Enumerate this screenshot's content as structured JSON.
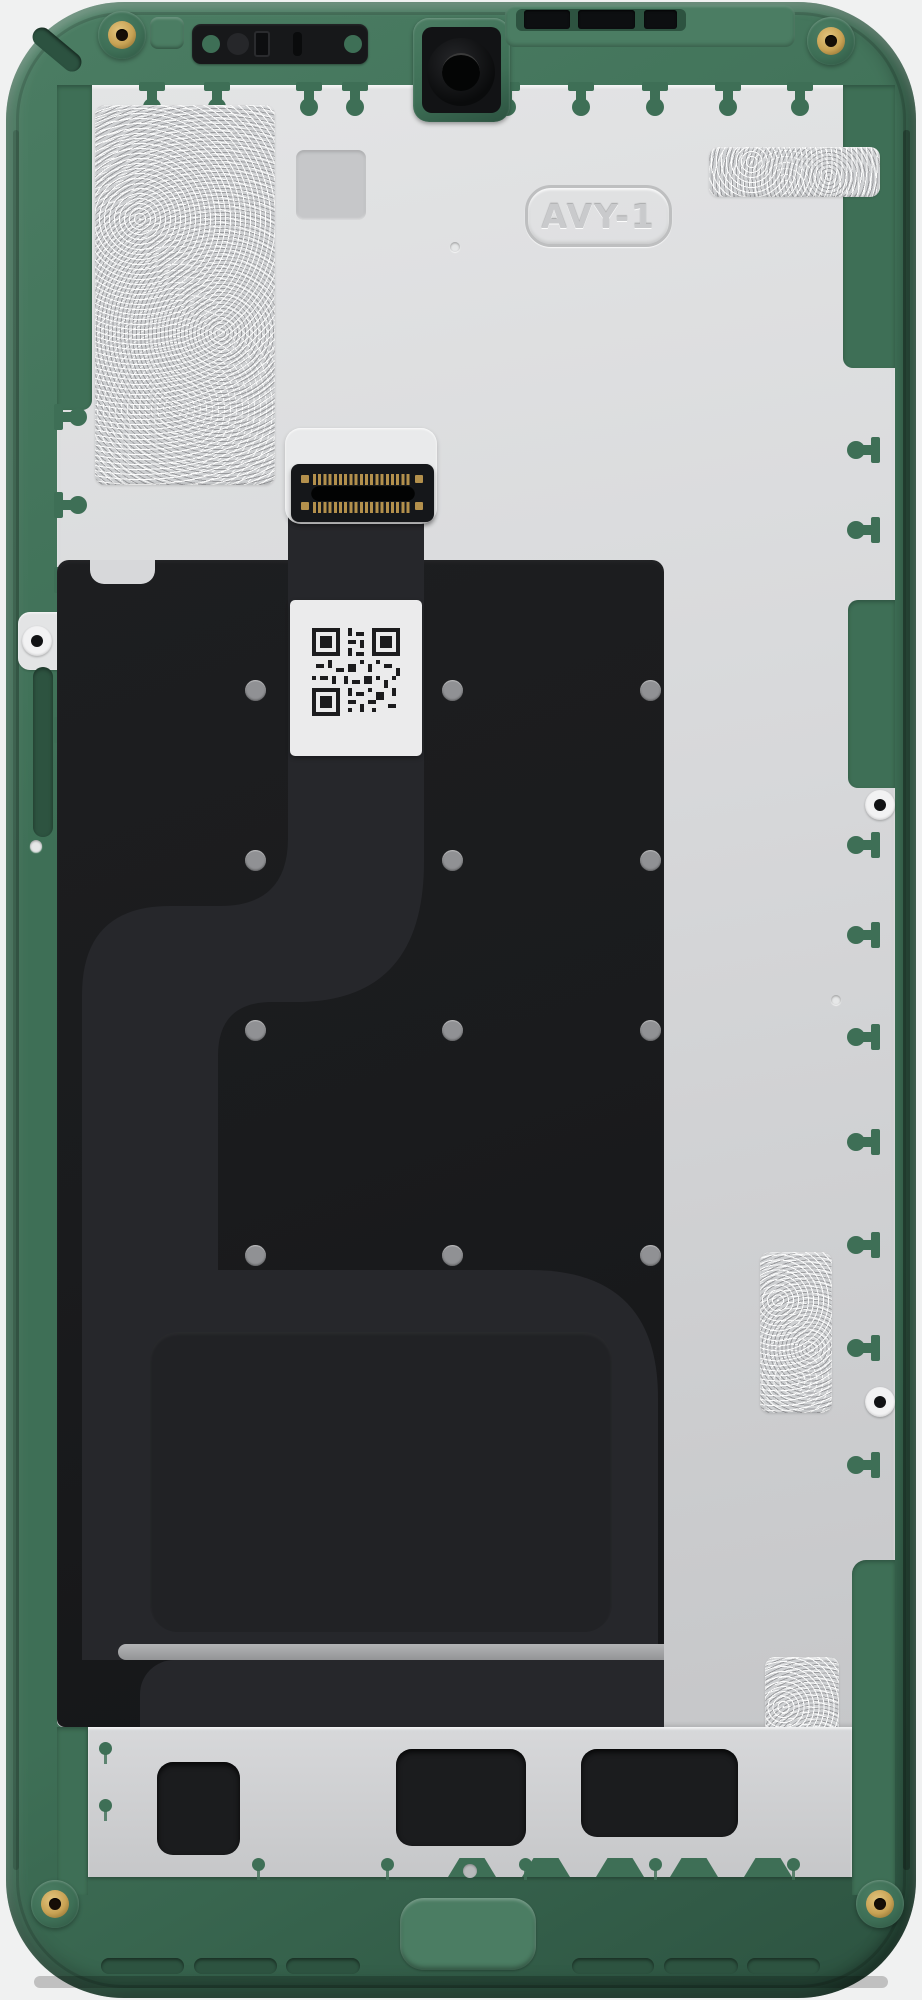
{
  "scene": {
    "type": "product-photo",
    "subject": "smartphone display assembly, rear view, green mid-frame with silver EMI shield, graphite sheet, display flex cable and QR label",
    "orientation": "portrait"
  },
  "labels": {
    "shield_emboss": "AVY-1"
  },
  "palette": {
    "bg": "#f0f1f1",
    "frame": "#3e6f56",
    "frameDark": "#2c5240",
    "frameLight": "#4b7d63",
    "pin": "#3e6f56",
    "shield": "#d7d8da",
    "shieldLight": "#e3e4e5",
    "shieldDark": "#c6c7c9",
    "foil": "#ced0d2",
    "panel": "#1a1b1d",
    "flex": "#26272b",
    "flexDark": "#212225",
    "connector": "#15171a",
    "gold": "#b3904c",
    "brass": "#c8a254",
    "label": "#ebebec",
    "dotGray": "#909194",
    "slotDark": "#2d5340",
    "qrInk": "#1c1c1e"
  },
  "components": {
    "frame": "green polymer mid-frame",
    "shield": "silver graphite-coated EMI shield plate with jigsaw tab edges",
    "earpiece": "earpiece speaker recess",
    "front_camera": "front camera lens in green mount",
    "antenna_slots": "antenna line slots, top edge",
    "corner_screws": "brass threaded screw inserts, four corners",
    "flex_cable": "display flex ribbon with S-curve routing",
    "board_connector": "board-to-board connector with gold contacts",
    "qr_label": "white QR code service label",
    "foil_patches": "textured adhesive foil patches",
    "bottom_bracket": "lower metal bracket with component cutouts",
    "bottom_slots": "speaker / microphone slots in bottom frame"
  },
  "repeats": {
    "pins_top": [
      {
        "left": 147,
        "top": 85
      },
      {
        "left": 212,
        "top": 85
      },
      {
        "left": 304,
        "top": 85
      },
      {
        "left": 350,
        "top": 85
      },
      {
        "left": 428,
        "top": 85
      },
      {
        "left": 502,
        "top": 85
      },
      {
        "left": 576,
        "top": 85
      },
      {
        "left": 650,
        "top": 85
      },
      {
        "left": 723,
        "top": 85
      },
      {
        "left": 795,
        "top": 85
      }
    ],
    "pins_leftedge": [
      {
        "left": 57,
        "top": 412
      },
      {
        "left": 57,
        "top": 500
      },
      {
        "left": 57,
        "top": 575
      },
      {
        "left": 57,
        "top": 725
      },
      {
        "left": 57,
        "top": 930
      },
      {
        "left": 57,
        "top": 1145
      },
      {
        "left": 57,
        "top": 1380
      },
      {
        "left": 57,
        "top": 1630
      }
    ],
    "pins_rightedge": [
      {
        "left": 857,
        "top": 445
      },
      {
        "left": 857,
        "top": 525
      },
      {
        "left": 857,
        "top": 840
      },
      {
        "left": 857,
        "top": 930
      },
      {
        "left": 857,
        "top": 1032
      },
      {
        "left": 857,
        "top": 1137
      },
      {
        "left": 857,
        "top": 1240
      },
      {
        "left": 857,
        "top": 1343
      },
      {
        "left": 857,
        "top": 1460
      }
    ],
    "foil_patches": [
      {
        "left": 95,
        "top": 105,
        "width": 180,
        "height": 380
      },
      {
        "left": 709,
        "top": 147,
        "width": 171,
        "height": 50
      },
      {
        "left": 760,
        "top": 1252,
        "width": 72,
        "height": 161
      },
      {
        "left": 765,
        "top": 1657,
        "width": 74,
        "height": 167
      }
    ],
    "panel_dots": [
      {
        "left": 245,
        "top": 680
      },
      {
        "left": 442,
        "top": 680
      },
      {
        "left": 640,
        "top": 680
      },
      {
        "left": 245,
        "top": 850
      },
      {
        "left": 442,
        "top": 850
      },
      {
        "left": 640,
        "top": 850
      },
      {
        "left": 245,
        "top": 1020
      },
      {
        "left": 442,
        "top": 1020
      },
      {
        "left": 640,
        "top": 1020
      },
      {
        "left": 245,
        "top": 1245
      },
      {
        "left": 442,
        "top": 1245
      },
      {
        "left": 640,
        "top": 1245
      }
    ],
    "shield_dimples": [
      {
        "left": 450,
        "top": 242,
        "width": 10,
        "height": 10
      },
      {
        "left": 831,
        "top": 995,
        "width": 10,
        "height": 10
      },
      {
        "left": 30,
        "top": 840,
        "width": 12,
        "height": 12
      }
    ],
    "shield_holes": [
      {
        "left": 865,
        "top": 790
      },
      {
        "left": 865,
        "top": 1387
      },
      {
        "left": 22,
        "top": 626
      }
    ],
    "connector_pads": [
      {
        "left": 301,
        "top": 475
      },
      {
        "left": 415,
        "top": 475
      },
      {
        "left": 301,
        "top": 502
      },
      {
        "left": 415,
        "top": 502
      }
    ],
    "bracket_cutouts": [
      {
        "left": 157,
        "top": 1762,
        "width": 83,
        "height": 93
      },
      {
        "left": 396,
        "top": 1749,
        "width": 130,
        "height": 97
      },
      {
        "left": 581,
        "top": 1749,
        "width": 157,
        "height": 88
      }
    ],
    "bracket_tabs": [
      {
        "left": 448,
        "top": 1858
      },
      {
        "left": 522,
        "top": 1858
      },
      {
        "left": 596,
        "top": 1858
      },
      {
        "left": 670,
        "top": 1858
      },
      {
        "left": 744,
        "top": 1858
      }
    ],
    "rivets_green": [
      {
        "left": 252,
        "top": 1858
      },
      {
        "left": 381,
        "top": 1858
      },
      {
        "left": 519,
        "top": 1858
      },
      {
        "left": 649,
        "top": 1858
      },
      {
        "left": 787,
        "top": 1858
      },
      {
        "left": 99,
        "top": 1742
      },
      {
        "left": 99,
        "top": 1799
      }
    ],
    "rivets_gray": [
      {
        "left": 463,
        "top": 1864
      }
    ],
    "bottom_slots": [
      {
        "left": 101,
        "top": 1958,
        "width": 83
      },
      {
        "left": 194,
        "top": 1958,
        "width": 83
      },
      {
        "left": 286,
        "top": 1958,
        "width": 74
      },
      {
        "left": 572,
        "top": 1958,
        "width": 82
      },
      {
        "left": 664,
        "top": 1958,
        "width": 74
      },
      {
        "left": 747,
        "top": 1958,
        "width": 73
      }
    ],
    "antenna_slots": [
      {
        "left": 524,
        "top": 10,
        "width": 46
      },
      {
        "left": 578,
        "top": 10,
        "width": 57
      },
      {
        "left": 644,
        "top": 10,
        "width": 33
      }
    ],
    "screws": [
      {
        "left": 98,
        "top": 11
      },
      {
        "left": 807,
        "top": 17
      },
      {
        "left": 31,
        "top": 1880
      },
      {
        "left": 856,
        "top": 1880
      }
    ]
  }
}
